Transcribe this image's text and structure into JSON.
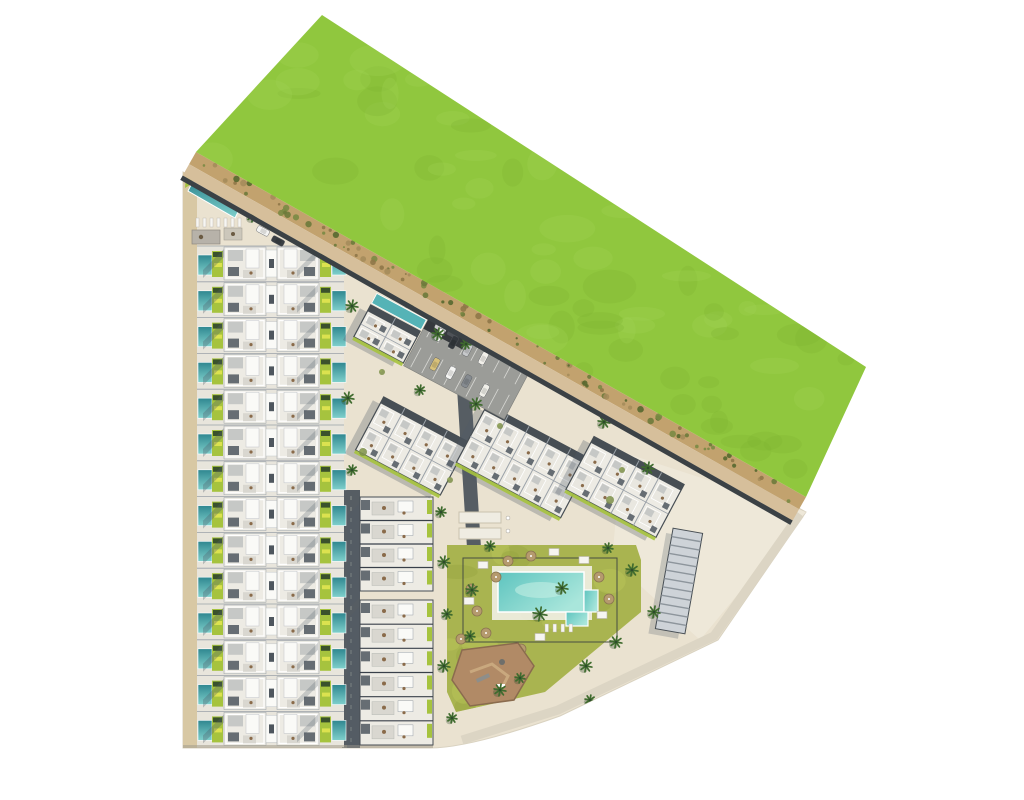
{
  "site": {
    "canvas": {
      "w": 1024,
      "h": 800
    },
    "description": "Aerial top-down architectural masterplan rendering of a residential development: rows of townhouses with private pools, angled apartment blocks, communal pool garden, playground, parking and a large green field bordered by a dirt path",
    "summary": {
      "townhouse_rows": 14,
      "townhouse_units": 28,
      "angled_apartment_blocks": 4,
      "south_apartment_blocks": 2,
      "communal_pools": 2,
      "parking_cars": 10,
      "playgrounds": 1,
      "petanque_courts": 2
    },
    "palette": {
      "ground": "#eae2d0",
      "path_tan": "#d8c8a4",
      "field": "#90c73e",
      "field_dark": "#7db232",
      "field_light": "#a2d455",
      "strip": "#c2a26e",
      "strip_tan": "#d6bf9b",
      "road_dark": "#3b4145",
      "road_gray": "#565d63",
      "se_road": "#dcd5c4",
      "plaza": "#efe9da",
      "roof_white": "#edebe4",
      "roof_bright": "#fafaf7",
      "roof_gray": "#c6c8c6",
      "roof_dark": "#666d73",
      "outline": "#474e54",
      "sep": "#9aa1a8",
      "spine_dark": "#4e565e",
      "terrace": "#d9d7d0",
      "furniture": "#8a6b4a",
      "pool_dark": "#2f8790",
      "pool_mid": "#55b3b6",
      "pool_light": "#7fd0cc",
      "pool_big1": "#5ec4bf",
      "pool_big2": "#a9e6db",
      "lawn": "#a6c33e",
      "planter": "#3a512c",
      "lounger_yellow": "#dce24f",
      "amen_lawn": "#a9b450",
      "amen_lawn_dark": "#96a340",
      "amen_lawn_light": "#bac659",
      "palm": "#3f6b2e",
      "palm_dark": "#2e4a2c",
      "play_brown": "#b18a66",
      "play_edge": "#8a6b4e",
      "umbrella": "#b59a6e",
      "shadow": "#4e5a68",
      "asphalt": "#9b9c98",
      "car_port": "#35393d",
      "court": "#efece2",
      "padel_fill": "#ced3d8",
      "padel_line": "#8d959c",
      "bottom_shadow": "#a9a191",
      "white": "#ffffff"
    },
    "ground": {
      "path": "M183,172 L806,512 L718,640 L560,716 Q470,748 430,748 L183,748 Z"
    },
    "left_path": {
      "x": 183,
      "y": 172,
      "w": 14,
      "h": 576
    },
    "field": {
      "points": [
        [
          322,
          15
        ],
        [
          866,
          367
        ],
        [
          806,
          497
        ],
        [
          196,
          152
        ]
      ],
      "blobs": 70
    },
    "strip": {
      "a": [
        196,
        152
      ],
      "b": [
        806,
        497
      ],
      "speckles": 95
    },
    "se_road": {
      "points": [
        [
          800,
          514
        ],
        [
          714,
          636
        ],
        [
          558,
          710
        ],
        [
          462,
          740
        ]
      ]
    },
    "plaza": {
      "points": [
        [
          622,
          452
        ],
        [
          806,
          512
        ],
        [
          700,
          640
        ],
        [
          612,
          560
        ]
      ]
    },
    "roads": {
      "r1": {
        "x": 342,
        "y": 490,
        "w": 18,
        "h": 258
      },
      "r2": {
        "x1": 463,
        "y1": 372,
        "x2": 474,
        "y2": 548,
        "w": 14
      }
    },
    "townhouses": {
      "x": 197,
      "y0": 246,
      "rows": 14,
      "row_h": 35.8,
      "right": 344
    },
    "lap_area": {
      "green": [
        [
          186,
          176
        ],
        [
          238,
          205
        ],
        [
          240,
          210
        ],
        [
          193,
          183
        ],
        [
          185,
          188
        ]
      ],
      "pool": [
        [
          193,
          181
        ],
        [
          240,
          208
        ],
        [
          235,
          218
        ],
        [
          188,
          191
        ]
      ],
      "loungers": {
        "x": 196,
        "y": 218,
        "n": 7
      },
      "pergola1": [
        192,
        230,
        28,
        14
      ],
      "pergola2": [
        224,
        228,
        18,
        12
      ]
    },
    "band_b": {
      "x": 360,
      "w": 73,
      "blocks": [
        {
          "y": 497,
          "h": 94,
          "units": 4
        },
        {
          "y": 600,
          "h": 145,
          "units": 6
        }
      ]
    },
    "angled_blocks": [
      {
        "cx": 387,
        "cy": 334,
        "w": 56,
        "h": 36,
        "rot": 28,
        "cols": 2,
        "pool": true
      },
      {
        "cx": 412,
        "cy": 446,
        "w": 96,
        "h": 60,
        "rot": 28,
        "cols": 4
      },
      {
        "cx": 524,
        "cy": 461,
        "w": 118,
        "h": 66,
        "rot": 28,
        "cols": 5
      },
      {
        "cx": 625,
        "cy": 487,
        "w": 102,
        "h": 60,
        "rot": 28,
        "cols": 4
      }
    ],
    "parking": {
      "cx": 468,
      "cy": 366,
      "w": 114,
      "h": 60,
      "rot": 28,
      "cars": [
        [
          -40,
          -14,
          "#f5f5f3"
        ],
        [
          -24,
          -14,
          "#33383d"
        ],
        [
          -8,
          -14,
          "#c7c9cb"
        ],
        [
          10,
          -14,
          "#f2f0ea"
        ],
        [
          -30,
          14,
          "#d9c27a"
        ],
        [
          -12,
          14,
          "#f5f5f3"
        ],
        [
          6,
          14,
          "#868b90"
        ],
        [
          26,
          14,
          "#f0efe9"
        ]
      ],
      "carport": [
        -57,
        -32,
        44,
        20
      ],
      "carport_cars": [
        [
          -48,
          -24,
          "#e8e8e6"
        ],
        [
          -34,
          -24,
          "#52575c"
        ]
      ]
    },
    "road_cars": [
      [
        263,
        231,
        28,
        "#f4f4f2"
      ],
      [
        278,
        241,
        28,
        "#3a3f44"
      ],
      [
        566,
        277,
        28,
        "#f4f4f2"
      ]
    ],
    "pool_area": {
      "lawn": "M447,545 L636,545 L641,560 L641,612 L545,692 L456,712 L447,692 Z",
      "fence": [
        463,
        558,
        154,
        84
      ],
      "deck": [
        492,
        566,
        100,
        54
      ],
      "pool": [
        498,
        572,
        86,
        40
      ],
      "pool_side": [
        584,
        590,
        14,
        22
      ],
      "pool_arm": [
        566,
        612,
        22,
        14
      ],
      "umbrellas": [
        [
          471,
          589
        ],
        [
          477,
          611
        ],
        [
          486,
          633
        ],
        [
          508,
          561
        ],
        [
          531,
          556
        ],
        [
          599,
          577
        ],
        [
          609,
          599
        ],
        [
          521,
          649
        ],
        [
          461,
          639
        ],
        [
          496,
          577
        ]
      ],
      "cabanas": [
        [
          483,
          565
        ],
        [
          554,
          552
        ],
        [
          584,
          560
        ],
        [
          602,
          615
        ],
        [
          540,
          637
        ],
        [
          469,
          601
        ]
      ],
      "loungers": [
        [
          545,
          624
        ],
        [
          553,
          624
        ],
        [
          561,
          624
        ],
        [
          569,
          624
        ]
      ],
      "blobs": 16
    },
    "playground": {
      "points": [
        [
          462,
          650
        ],
        [
          518,
          643
        ],
        [
          534,
          666
        ],
        [
          514,
          700
        ],
        [
          470,
          706
        ],
        [
          452,
          680
        ]
      ]
    },
    "petanque": {
      "courts": [
        [
          459,
          512,
          42,
          11
        ],
        [
          459,
          528,
          42,
          11
        ]
      ],
      "seats": [
        [
          508,
          518
        ],
        [
          508,
          531
        ]
      ]
    },
    "padel": {
      "cx": 679,
      "cy": 581,
      "w": 30,
      "h": 102,
      "rot": 10,
      "stripes": 12
    },
    "palms": [
      [
        253,
        216,
        6
      ],
      [
        352,
        306,
        6
      ],
      [
        348,
        398,
        6
      ],
      [
        410,
        302,
        5
      ],
      [
        438,
        334,
        6
      ],
      [
        466,
        344,
        5
      ],
      [
        476,
        404,
        6
      ],
      [
        352,
        470,
        5
      ],
      [
        560,
        374,
        5
      ],
      [
        604,
        422,
        6
      ],
      [
        648,
        468,
        6
      ],
      [
        441,
        512,
        5
      ],
      [
        444,
        562,
        6
      ],
      [
        447,
        614,
        5
      ],
      [
        444,
        666,
        6
      ],
      [
        452,
        718,
        5
      ],
      [
        490,
        546,
        5
      ],
      [
        472,
        590,
        6
      ],
      [
        470,
        636,
        5
      ],
      [
        500,
        690,
        6
      ],
      [
        540,
        614,
        7
      ],
      [
        562,
        588,
        6
      ],
      [
        586,
        666,
        6
      ],
      [
        616,
        642,
        6
      ],
      [
        632,
        570,
        6
      ],
      [
        520,
        678,
        5
      ],
      [
        608,
        548,
        5
      ],
      [
        654,
        612,
        6
      ],
      [
        590,
        700,
        5
      ],
      [
        420,
        390,
        5
      ]
    ],
    "bushes": [
      [
        368,
        256,
        4
      ],
      [
        428,
        292,
        3
      ],
      [
        363,
        452,
        4
      ],
      [
        450,
        480,
        3
      ],
      [
        610,
        500,
        4
      ],
      [
        622,
        470,
        3
      ],
      [
        500,
        426,
        3
      ],
      [
        382,
        372,
        3
      ]
    ]
  }
}
